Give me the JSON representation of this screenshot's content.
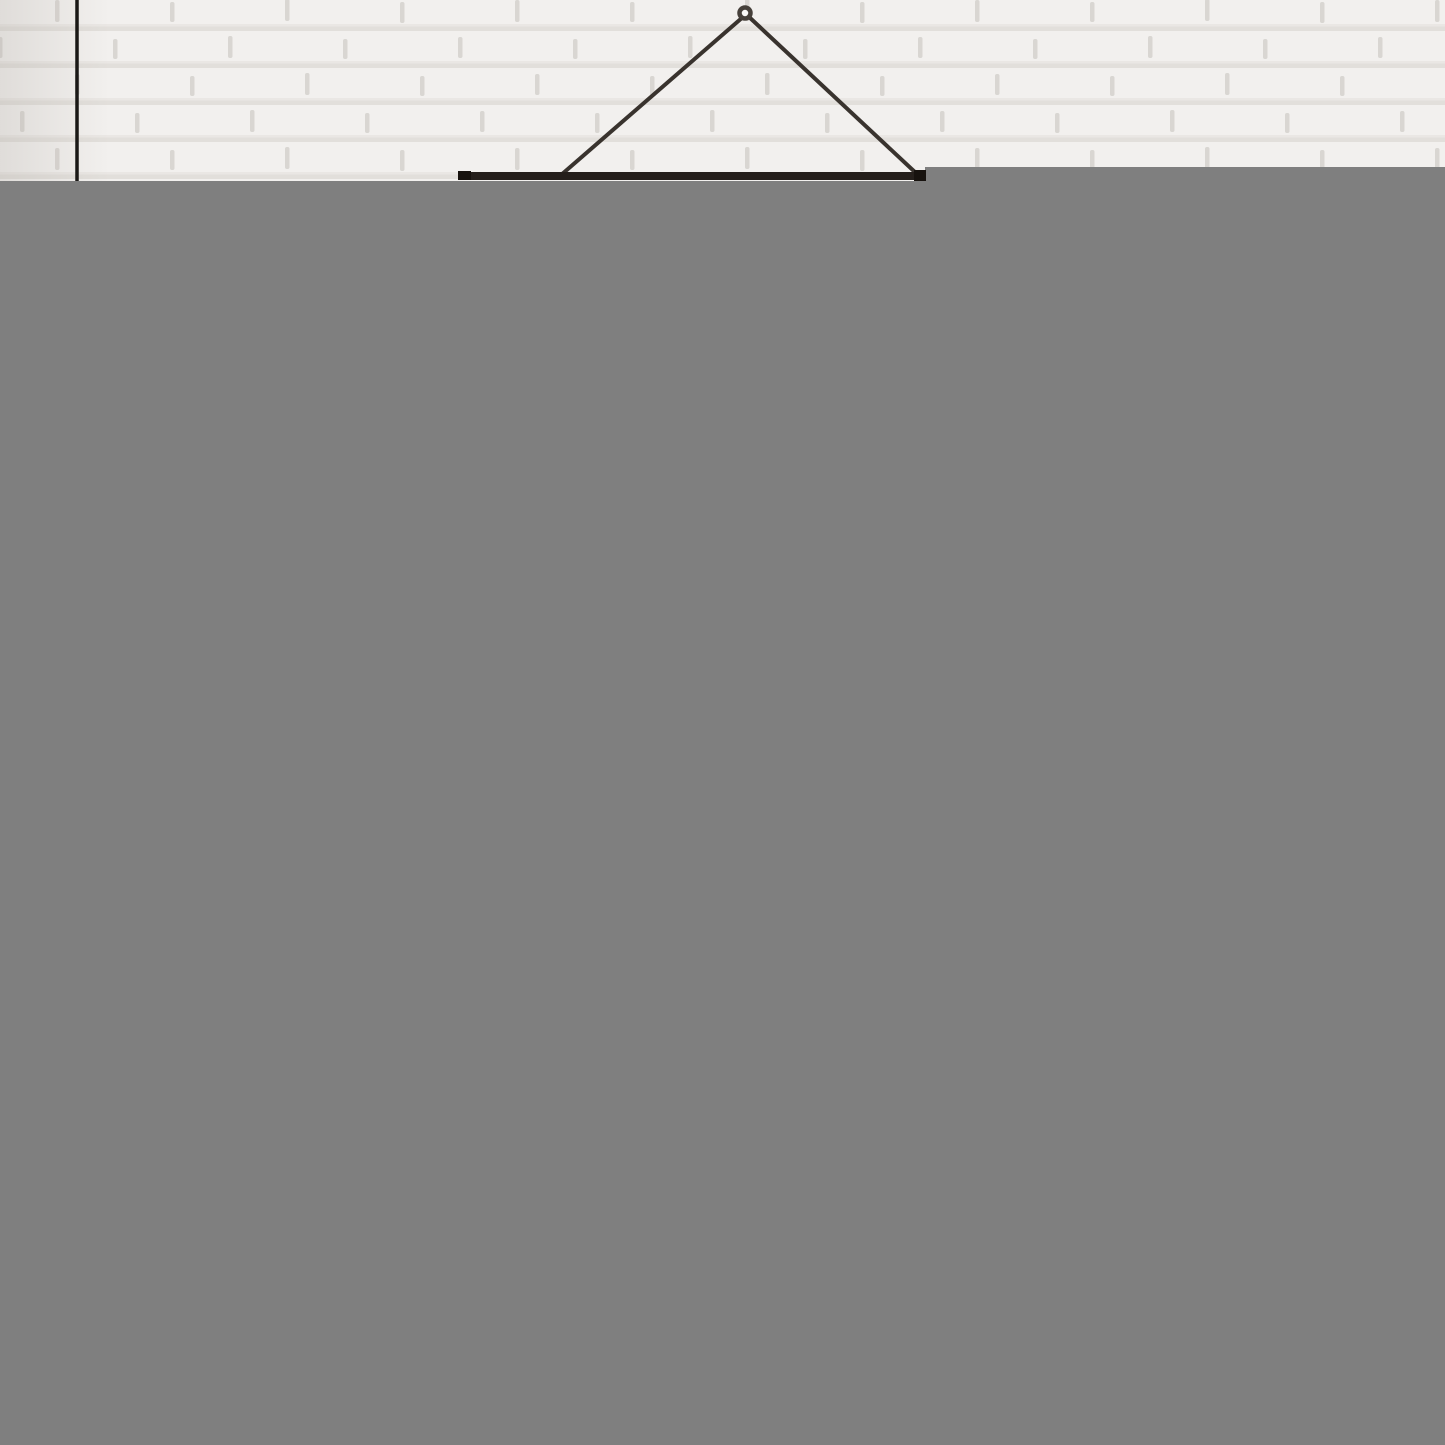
{
  "scene": {
    "description": "Partially decoded photograph: black wire poster hanger on a white painted brick wall; lower area of the image is an undecoded flat gray placeholder block",
    "canvas": {
      "width": 1445,
      "height": 1445
    },
    "colors": {
      "placeholder_gray": "#7f7f7f",
      "wall_base": "#f2f0ee",
      "wall_mortar": "#e2dfdb",
      "wall_mortar_soft": "#eae7e4",
      "wall_joint": "#d9d6d2",
      "edge_shade": "#b4afa9",
      "cord_black": "#1b1917",
      "wire_dark": "#39332e",
      "bar_dark": "#251f1b",
      "bar_cap_dark": "#17120e",
      "ring_stroke": "#46403a",
      "ring_hole": "#faf9f7"
    },
    "gray_region": {
      "x": 0,
      "y": 167,
      "width": 1445,
      "height": 1278
    },
    "wall": {
      "points": "0,0 1445,0 1445,167 925,167 925,181 0,181"
    },
    "cord": {
      "x1": 77,
      "y1": 0,
      "x2": 77,
      "y2": 181,
      "width": 3.5
    },
    "hanger": {
      "left_wire": {
        "x1": 743,
        "y1": 17,
        "x2": 561,
        "y2": 175,
        "width": 4
      },
      "right_wire": {
        "x1": 748,
        "y1": 16,
        "x2": 917,
        "y2": 174,
        "width": 4
      },
      "bar": {
        "x": 458,
        "y": 172,
        "width": 468,
        "height": 8
      },
      "left_cap": {
        "x": 458,
        "y": 171,
        "width": 13,
        "height": 9
      },
      "right_cap": {
        "x": 914,
        "y": 170,
        "width": 12,
        "height": 11
      },
      "ring": {
        "cx": 745,
        "cy": 13,
        "r": 5.5,
        "stroke_width": 4.5
      }
    }
  }
}
